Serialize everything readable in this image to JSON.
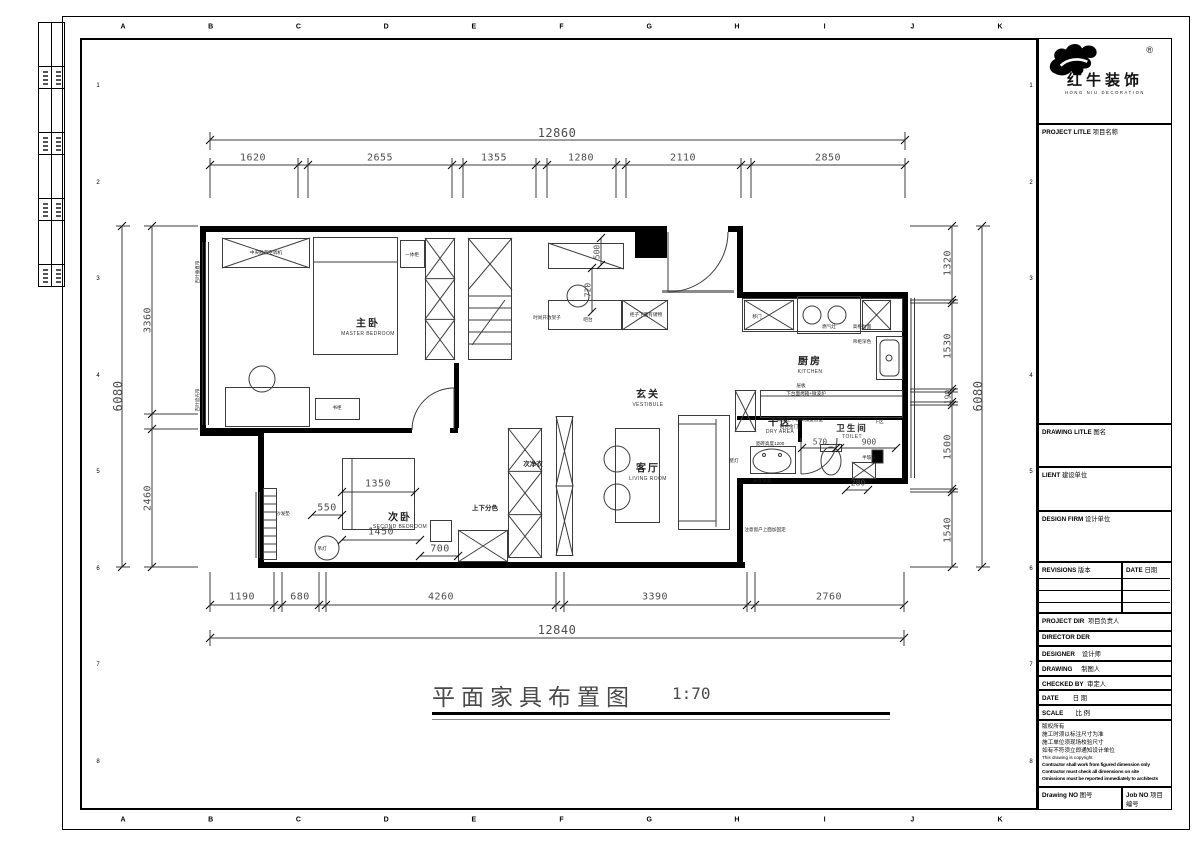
{
  "frame": {
    "top_letters": [
      "A",
      "B",
      "C",
      "D",
      "E",
      "F",
      "G",
      "H",
      "I",
      "J",
      "K"
    ],
    "bottom_letters": [
      "A",
      "B",
      "C",
      "D",
      "E",
      "F",
      "G",
      "H",
      "I",
      "J",
      "K"
    ],
    "left_numbers": [
      "1",
      "2",
      "3",
      "4",
      "5",
      "6",
      "7",
      "8"
    ],
    "right_numbers": [
      "1",
      "2",
      "3",
      "4",
      "5",
      "6",
      "7",
      "8"
    ]
  },
  "logo": {
    "reg": "®",
    "cn": "红牛装饰",
    "en": "HONG NIU DECORATION"
  },
  "title_block": {
    "project_title": {
      "en": "PROJECT LITLE",
      "cn": "项目名称"
    },
    "drawing_title": {
      "en": "DRAWING LITLE",
      "cn": "图名"
    },
    "client": {
      "en": "LIENT",
      "cn": "建设单位"
    },
    "design_firm": {
      "en": "DESIGN FIRM",
      "cn": "设计单位"
    },
    "revisions": {
      "en": "REVISIONS",
      "cn": "版本"
    },
    "rev_date": {
      "en": "DATE",
      "cn": "日期"
    },
    "project_dir": {
      "en": "PROJECT DIR",
      "cn": "项目负责人"
    },
    "director": {
      "en": "DIRECTOR DER",
      "cn": ""
    },
    "designer": {
      "en": "DESIGNER",
      "cn": "设计师"
    },
    "drawing": {
      "en": "DRAWING",
      "cn": "制图人"
    },
    "checked_by": {
      "en": "CHECKED BY",
      "cn": "审定人"
    },
    "date": {
      "en": "DATE",
      "cn": "日 期"
    },
    "scale": {
      "en": "SCALE",
      "cn": "比 例"
    },
    "drawing_no": {
      "en": "Drawing NO",
      "cn": "图号"
    },
    "job_no": {
      "en": "Job NO",
      "cn": "项目编号"
    },
    "copyright": [
      "版权所有",
      "施工时须以标注尺寸为准",
      "施工单位须现场校验尺寸",
      "如有不符须立即通知设计单位",
      "This drawing is copyright",
      "Contractor shall work from figured dimension only",
      "Contractor must check all dimensions on site",
      "Omissions must be reported immediately to architects"
    ]
  },
  "drawing_label": {
    "title": "平面家具布置图",
    "scale": "1:70"
  },
  "dimensions": {
    "top": {
      "total": "12860",
      "segments": [
        "1620",
        "2655",
        "1355",
        "1280",
        "2110",
        "2850"
      ]
    },
    "bottom": {
      "total": "12840",
      "segments": [
        "1190",
        "680",
        "4260",
        "3390",
        "2760"
      ]
    },
    "left": {
      "total": "6080",
      "segments": [
        "3360",
        "2460"
      ]
    },
    "right": {
      "total": "6080",
      "segments": [
        "1320",
        "1530",
        "190",
        "1500",
        "1540"
      ]
    },
    "inner": {
      "alcove_w": "500",
      "alcove_d": "720",
      "bed2_w": "1350",
      "bed2_off": "550",
      "bed2_len": "1450",
      "cabinet": "700",
      "toilet_a": "570",
      "toilet_b": "900",
      "toilet_c": "280"
    }
  },
  "rooms": {
    "master": {
      "cn": "主卧",
      "en": "MASTER BEDROOM"
    },
    "vestibule": {
      "cn": "玄关",
      "en": "VESTIBULE"
    },
    "kitchen": {
      "cn": "厨房",
      "en": "KITCHEN"
    },
    "dry": {
      "cn": "干区",
      "en": "DRY AREA"
    },
    "toilet": {
      "cn": "卫生间",
      "en": "TOILET"
    },
    "living": {
      "cn": "客厅",
      "en": "LIVING ROOM"
    },
    "second": {
      "cn": "次卧",
      "en": "SECOND BEDROOM"
    }
  },
  "annotations": {
    "ac_cabinet": "中央静音空调机",
    "allinone_cabinet": "一体柜",
    "bookcase": "书柜",
    "open_shelf": "时尚开放架子",
    "bar_counter": "吧台",
    "under_cabinet_storage": "柜子下面有储物",
    "sliding_door": "移门",
    "gas_stove": "燃气灶",
    "tall_cabinet_top": "高柜台面",
    "dark_wall_cabinet": "吊柜深色",
    "shelf_board": "层板",
    "under_counter_oven": "下台面烤箱+微波炉",
    "tile_height": "瓷砖高度1200",
    "black_glass_door_1": "黑色上半玻璃弧型造型",
    "black_glass_door_2": "铝合金门",
    "lower_zone": "下区",
    "half_glass": "半玻璃",
    "mirror": "异性镜面",
    "wall_lamp": "壁灯",
    "two_tone": "上下分色",
    "second_closet": "次净衣",
    "pendant_lamp": "吊灯",
    "sofa_pad": "沙发垫",
    "blind_curtain_1": "百叶垂直帘",
    "blind_curtain_2": "百叶遮光帘",
    "window_fix_note": "注意窗户上面加固定"
  }
}
